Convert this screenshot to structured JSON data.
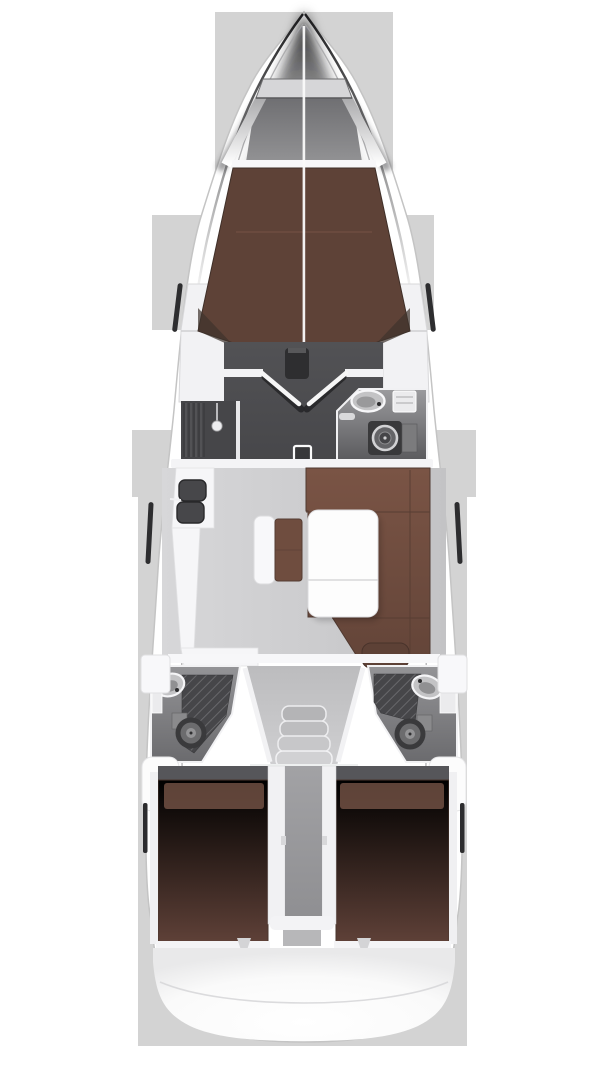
{
  "meta": {
    "title": "Sailing yacht interior layout plan (overhead view)",
    "view": "top-down",
    "canvas": {
      "width": 608,
      "height": 1080
    }
  },
  "colors": {
    "background": "#ffffff",
    "silhouette": "#d3d3d3",
    "hull_white": "#ffffff",
    "hull_outline": "#c4c4c4",
    "wall_white": "#f4f4f6",
    "bulkhead_white": "#f7f7f9",
    "platform_gray": "#d6d6d8",
    "berth_v_brown": "#5e4237",
    "berth_foot_gray": "#ababad",
    "wardrobe_white": "#f2f2f4",
    "floor_forward": "#4e4e51",
    "mast_block": "#2e2e30",
    "hatch_square": "#38383a",
    "shower_floor": "#464649",
    "shower_head_white": "#ededef",
    "salon_floor": "#cacacc",
    "settee_brown": "#6f4c3f",
    "cushion_brown": "#6f4d3f",
    "pillow_brown": "#5d4136",
    "pillow_light": "#7d5a4b",
    "table_white": "#fdfdfd",
    "counter_white": "#f6f6f8",
    "sink_dark": "#47474a",
    "oven_handle": "#2f2f31",
    "aft_berth_brown": "#684740",
    "berth_shadow": "#56565a",
    "divider_gray": "#9a9a9d",
    "divider_foot_gray": "#b7b7b9",
    "companionway_floor": "#c5c5c7",
    "stair1": "#b4b4b6",
    "stair2": "#bdbdbf",
    "stair3": "#c7c7c9",
    "stair4": "#d1d1d3",
    "toilet_outer": "#3a3a3c",
    "toilet_mid": "#6c6c6e",
    "toilet_inner": "#949496",
    "sink_rim_white": "#c3c3c5",
    "cabinet_white": "#ebebed",
    "locker_white": "#f8f8fa",
    "seat_white": "#fcfcfc",
    "window_slit": "#2d2d2f",
    "footboard_white": "#f4f4f6"
  },
  "regions": [
    {
      "id": "anchor-locker",
      "label": "bow anchor locker"
    },
    {
      "id": "forward-cabin",
      "label": "forward cabin V-berth"
    },
    {
      "id": "forward-head",
      "label": "forward head with sink and toilet"
    },
    {
      "id": "shower-stall",
      "label": "separate shower stall"
    },
    {
      "id": "saloon",
      "label": "saloon with U-settee and folding table"
    },
    {
      "id": "galley",
      "label": "L-shaped galley with twin sinks and stove"
    },
    {
      "id": "companionway",
      "label": "companionway entry steps"
    },
    {
      "id": "aft-head-port",
      "label": "port aft head"
    },
    {
      "id": "aft-head-starboard",
      "label": "starboard aft head"
    },
    {
      "id": "aft-cabin-port",
      "label": "port aft cabin double berth"
    },
    {
      "id": "aft-cabin-starboard",
      "label": "starboard aft cabin double berth"
    },
    {
      "id": "engine-compartment",
      "label": "center engine compartment"
    },
    {
      "id": "stern-platform",
      "label": "stern transom platform"
    }
  ]
}
